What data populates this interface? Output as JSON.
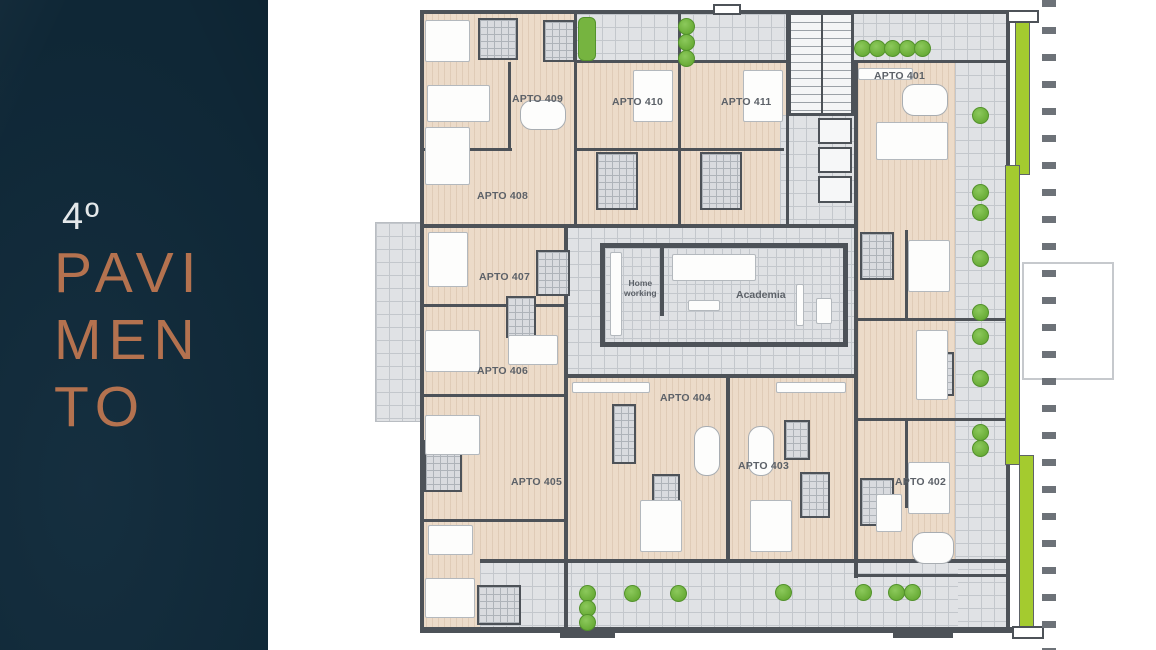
{
  "panel": {
    "floor_number": "4º",
    "title_line1": "PAVI",
    "title_line2": "MEN",
    "title_line3": "TO"
  },
  "plan": {
    "apartments": {
      "a401": "APTO 401",
      "a402": "APTO 402",
      "a403": "APTO 403",
      "a404": "APTO 404",
      "a405": "APTO 405",
      "a406": "APTO 406",
      "a407": "APTO 407",
      "a408": "APTO 408",
      "a409": "APTO 409",
      "a410": "APTO 410",
      "a411": "APTO 411"
    },
    "amenities": {
      "home_working_line1": "Home",
      "home_working_line2": "working",
      "academia": "Academia"
    }
  },
  "colors": {
    "panel_bg": "#0f2736",
    "accent_copper": "#b4724f",
    "floor_beige": "#ecdbc9",
    "common_gray": "#e0e2e5",
    "wall": "#4d5258",
    "greenery": "#72b33e",
    "green_strip": "#a4cb2f",
    "label_text": "#5c6168"
  }
}
